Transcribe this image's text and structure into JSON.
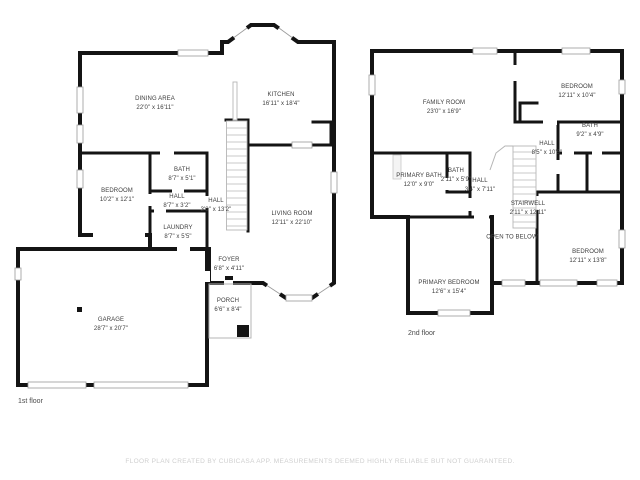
{
  "footer": "FLOOR PLAN CREATED BY CUBICASA APP. MEASUREMENTS DEEMED HIGHLY RELIABLE BUT NOT GUARANTEED.",
  "floor1": {
    "label": "1st floor",
    "rooms": [
      {
        "name": "DINING AREA",
        "dims": "22'0\" x 16'11\""
      },
      {
        "name": "KITCHEN",
        "dims": "16'11\" x 18'4\""
      },
      {
        "name": "BEDROOM",
        "dims": "10'2\" x 12'1\""
      },
      {
        "name": "BATH",
        "dims": "8'7\" x 5'1\""
      },
      {
        "name": "HALL",
        "dims": "8'7\" x 3'2\""
      },
      {
        "name": "LAUNDRY",
        "dims": "8'7\" x 5'5\""
      },
      {
        "name": "HALL",
        "dims": "3'8\" x 13'2\""
      },
      {
        "name": "LIVING ROOM",
        "dims": "12'11\" x 22'10\""
      },
      {
        "name": "FOYER",
        "dims": "6'8\" x 4'11\""
      },
      {
        "name": "PORCH",
        "dims": "6'6\" x 8'4\""
      },
      {
        "name": "GARAGE",
        "dims": "28'7\" x 20'7\""
      }
    ]
  },
  "floor2": {
    "label": "2nd floor",
    "rooms": [
      {
        "name": "FAMILY ROOM",
        "dims": "23'0\" x 16'9\""
      },
      {
        "name": "BEDROOM",
        "dims": "12'11\" x 10'4\""
      },
      {
        "name": "BATH",
        "dims": "9'2\" x 4'9\""
      },
      {
        "name": "HALL",
        "dims": "8'5\" x 10'5\""
      },
      {
        "name": "PRIMARY BATH",
        "dims": "12'0\" x 9'0\""
      },
      {
        "name": "BATH",
        "dims": "2'11\" x 5'9\""
      },
      {
        "name": "HALL",
        "dims": "3'4\" x 7'11\""
      },
      {
        "name": "STAIRWELL",
        "dims": "2'11\" x 12'11\""
      },
      {
        "name": "OPEN TO BELOW",
        "dims": ""
      },
      {
        "name": "BEDROOM",
        "dims": "12'11\" x 13'8\""
      },
      {
        "name": "PRIMARY BEDROOM",
        "dims": "12'6\" x 15'4\""
      }
    ]
  }
}
